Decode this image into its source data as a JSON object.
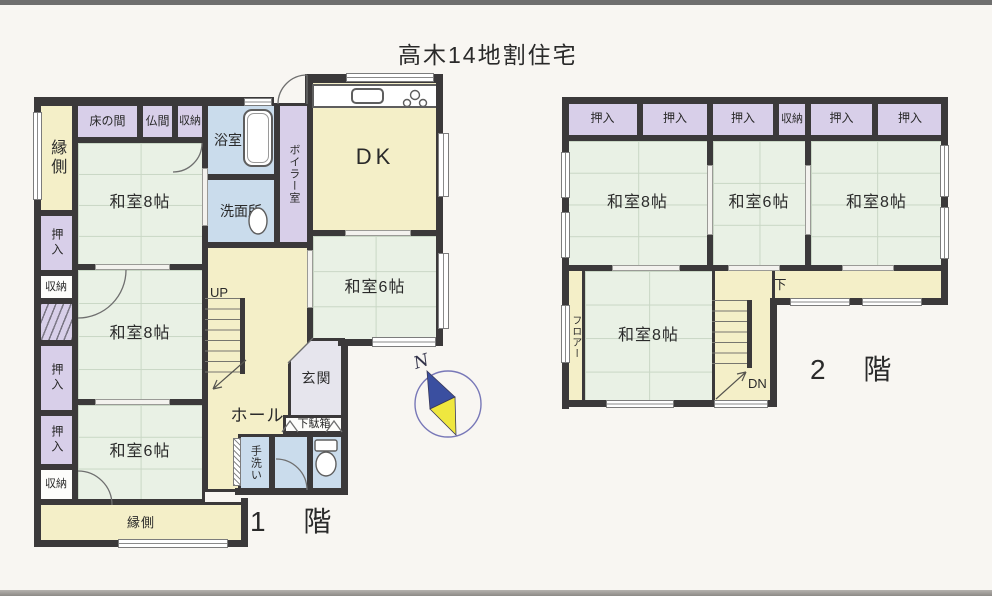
{
  "title": "高木14地割住宅",
  "floor1": {
    "floor_label": "1 階",
    "rooms": {
      "engawa_left": "縁側",
      "tokonoma": "床の間",
      "butsuma": "仏間",
      "shuunou_top": "収納",
      "yokushitsu": "浴室",
      "boiler": "ボイラー室",
      "senmenjo": "洗面所",
      "dk": "DK",
      "washitsu8_a": "和室8帖",
      "washitsu8_b": "和室8帖",
      "washitsu6_a": "和室6帖",
      "washitsu6_b": "和室6帖",
      "oshiire_1": "押入",
      "shuunou_left1": "収納",
      "oshiire_2": "押入",
      "oshiire_3": "押入",
      "shuunou_left2": "収納",
      "engawa_bottom": "縁側",
      "hall": "ホール",
      "genkan": "玄関",
      "getabako": "下駄箱",
      "tearai": "手洗い",
      "up": "UP"
    }
  },
  "floor2": {
    "floor_label": "2 階",
    "rooms": {
      "oshiire_1": "押入",
      "oshiire_2": "押入",
      "oshiire_3": "押入",
      "shuunou": "収納",
      "oshiire_4": "押入",
      "oshiire_5": "押入",
      "washitsu8_a": "和室8帖",
      "washitsu6": "和室6帖",
      "washitsu8_b": "和室8帖",
      "washitsu8_c": "和室8帖",
      "rouka": "廊下",
      "floor_strip": "フロアー",
      "dn": "DN"
    }
  },
  "compass": {
    "north": "N"
  },
  "colors": {
    "wall": "#3b393a",
    "tatami": "#e9f1e5",
    "closet": "#d8cfe9",
    "corridor": "#f4efc8",
    "wet_area": "#cadcec",
    "entrance": "#e6e5ed",
    "compass_blue": "#3a4fa0",
    "compass_yellow": "#efe73f",
    "background": "#f8f6f2"
  }
}
